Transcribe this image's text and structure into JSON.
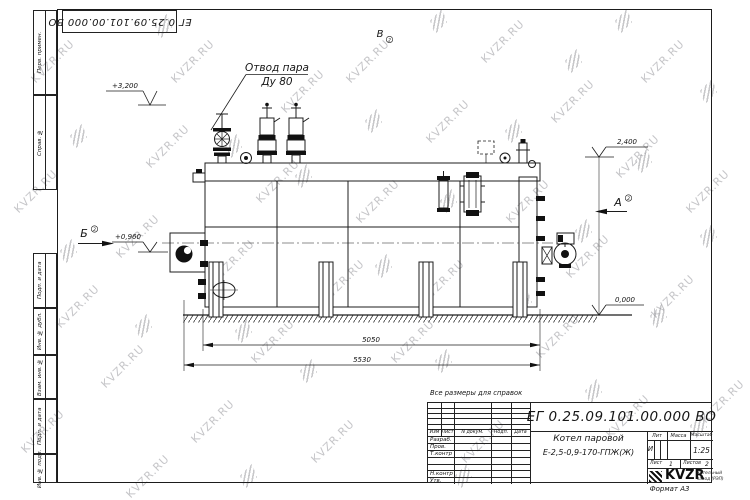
{
  "watermark": {
    "text": "KVZR.RU"
  },
  "corner_stamp": {
    "doc_number": "ЕГ 0.25.09.101.00.000  ВО"
  },
  "frame_left": {
    "cells": [
      "Перв. примен.",
      "Справ. №",
      "Подп. и дата",
      "Инв. № дубл.",
      "Взам. инв. №",
      "Подп. и дата",
      "Инв. № подл."
    ]
  },
  "drawing": {
    "callout": {
      "line1": "Отвод пара",
      "line2": "Ду 80"
    },
    "elevations": {
      "top": "+3,200",
      "right": "2,400",
      "burner": "+0,960",
      "ground": "0,000"
    },
    "views": {
      "b": "Б",
      "a": "А",
      "v": "В",
      "sheet_ref": "2"
    },
    "dimensions": {
      "inner": "5050",
      "outer": "5530"
    }
  },
  "note": "Все размеры для справок",
  "title_block": {
    "doc_number": "ЕГ 0.25.09.101.00.000  ВО",
    "name_line1": "Котел паровой",
    "name_line2": "Е-2,5-0,9-170-ГПЖ(Ж)",
    "cols": {
      "izm": "Изм",
      "list": "Лист",
      "ndokum": "N докум.",
      "podp": "Подп.",
      "data": "Дата"
    },
    "rows": [
      "Разраб.",
      "Пров.",
      "Т.контр",
      "",
      "Н.контр",
      "Утв."
    ],
    "lit": "Лит",
    "massa": "Масса",
    "masshtab": "Масштаб",
    "lit_value": "И",
    "masshtab_value": "1:25",
    "list_label": "Лист",
    "list_value": "1",
    "listov_label": "Листов",
    "listov_value": "2",
    "logo_text": "KVZR",
    "logo_sub1": "Котельный",
    "logo_sub2": "завод (РЭП)",
    "format": "Формат А3"
  }
}
